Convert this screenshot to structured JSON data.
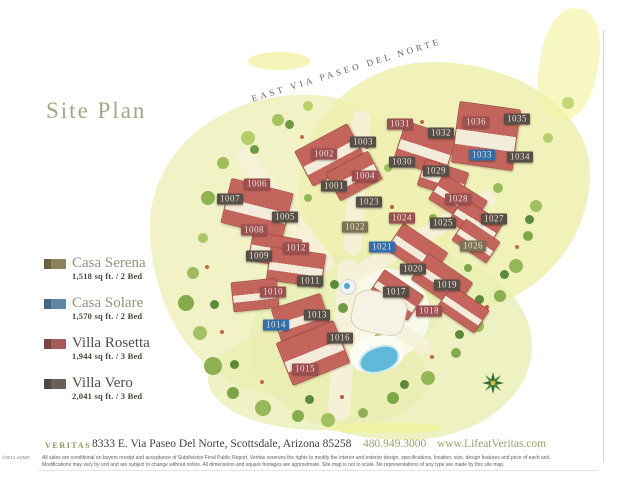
{
  "page": {
    "title": "Site Plan"
  },
  "map": {
    "street_label": "EAST VIA PASEO DEL NORTE",
    "type_colors": {
      "serena": "#7c7254",
      "solare": "#2f6fae",
      "rosetta": "#9c4f50",
      "vero": "#554f48"
    },
    "lots": [
      {
        "id": "1001",
        "type": "vero",
        "x": 334,
        "y": 186
      },
      {
        "id": "1002",
        "type": "rosetta",
        "x": 324,
        "y": 154
      },
      {
        "id": "1003",
        "type": "vero",
        "x": 363,
        "y": 142
      },
      {
        "id": "1004",
        "type": "rosetta",
        "x": 365,
        "y": 176
      },
      {
        "id": "1005",
        "type": "vero",
        "x": 285,
        "y": 217
      },
      {
        "id": "1006",
        "type": "rosetta",
        "x": 257,
        "y": 184
      },
      {
        "id": "1007",
        "type": "vero",
        "x": 230,
        "y": 199
      },
      {
        "id": "1008",
        "type": "rosetta",
        "x": 254,
        "y": 230
      },
      {
        "id": "1009",
        "type": "vero",
        "x": 259,
        "y": 256
      },
      {
        "id": "1010",
        "type": "rosetta",
        "x": 273,
        "y": 292
      },
      {
        "id": "1011",
        "type": "vero",
        "x": 310,
        "y": 281
      },
      {
        "id": "1012",
        "type": "rosetta",
        "x": 296,
        "y": 248
      },
      {
        "id": "1013",
        "type": "vero",
        "x": 317,
        "y": 315
      },
      {
        "id": "1014",
        "type": "solare",
        "x": 276,
        "y": 325
      },
      {
        "id": "1015",
        "type": "rosetta",
        "x": 305,
        "y": 369
      },
      {
        "id": "1016",
        "type": "vero",
        "x": 340,
        "y": 338
      },
      {
        "id": "1017",
        "type": "vero",
        "x": 396,
        "y": 292
      },
      {
        "id": "1018",
        "type": "rosetta",
        "x": 429,
        "y": 311
      },
      {
        "id": "1019",
        "type": "vero",
        "x": 447,
        "y": 285
      },
      {
        "id": "1020",
        "type": "vero",
        "x": 413,
        "y": 269
      },
      {
        "id": "1021",
        "type": "solare",
        "x": 382,
        "y": 247
      },
      {
        "id": "1022",
        "type": "serena",
        "x": 355,
        "y": 227
      },
      {
        "id": "1023",
        "type": "vero",
        "x": 369,
        "y": 202
      },
      {
        "id": "1024",
        "type": "rosetta",
        "x": 402,
        "y": 218
      },
      {
        "id": "1025",
        "type": "vero",
        "x": 443,
        "y": 223
      },
      {
        "id": "1026",
        "type": "serena",
        "x": 473,
        "y": 246
      },
      {
        "id": "1027",
        "type": "vero",
        "x": 494,
        "y": 219
      },
      {
        "id": "1028",
        "type": "rosetta",
        "x": 458,
        "y": 199
      },
      {
        "id": "1029",
        "type": "vero",
        "x": 436,
        "y": 171
      },
      {
        "id": "1030",
        "type": "vero",
        "x": 402,
        "y": 162
      },
      {
        "id": "1031",
        "type": "rosetta",
        "x": 400,
        "y": 124
      },
      {
        "id": "1032",
        "type": "vero",
        "x": 441,
        "y": 133
      },
      {
        "id": "1033",
        "type": "solare",
        "x": 482,
        "y": 155
      },
      {
        "id": "1034",
        "type": "vero",
        "x": 520,
        "y": 157
      },
      {
        "id": "1035",
        "type": "vero",
        "x": 517,
        "y": 119
      },
      {
        "id": "1036",
        "type": "rosetta",
        "x": 476,
        "y": 122
      }
    ]
  },
  "legend": {
    "items": [
      {
        "name": "Casa Serena",
        "details": "1,518 sq ft. / 2 Bed",
        "color": "#8d815c",
        "name_color": "#8d977c"
      },
      {
        "name": "Casa Solare",
        "details": "1,570 sq ft. / 2 Bed",
        "color": "#5d89a8",
        "name_color": "#8d977c"
      },
      {
        "name": "Villa Rosetta",
        "details": "1,944 sq ft. / 3 Bed",
        "color": "#a55c5e",
        "name_color": "#514c44"
      },
      {
        "name": "Villa Vero",
        "details": "2,041 sq ft. / 3 Bed",
        "color": "#6a6057",
        "name_color": "#514c44"
      }
    ]
  },
  "footer": {
    "brand": "VERITAS",
    "address": "8333 E. Via Paseo Del Norte, Scottsdale, Arizona 85258",
    "phone": "480.949.3000",
    "website": "www.LifeatVeritas.com",
    "copyright": "©2012 ADMR",
    "disclaimer": "All sales are conditional on buyers receipt and acceptance of Subdivision Final Public Report. Veritas reserves the rights to modify the interior and exterior design, specifications, location, size, design features and price of each unit. Modifications may vary by unit and are subject to change without notice. All dimensions and square footages are approximate. Site map is not to scale. No representations of any type are made by this site map."
  }
}
